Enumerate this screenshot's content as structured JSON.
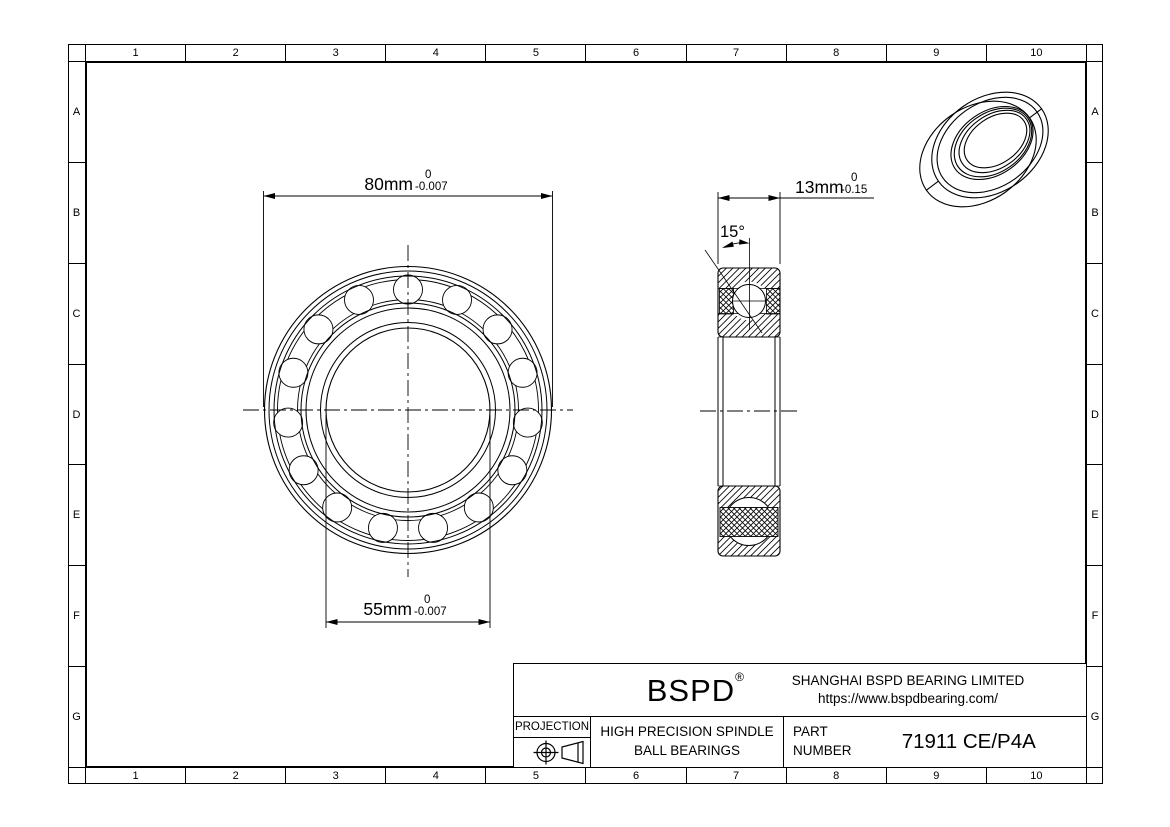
{
  "sheet": {
    "grid": {
      "columns": [
        "1",
        "2",
        "3",
        "4",
        "5",
        "6",
        "7",
        "8",
        "9",
        "10"
      ],
      "rows": [
        "A",
        "B",
        "C",
        "D",
        "E",
        "F",
        "G"
      ]
    },
    "colors": {
      "line": "#000000",
      "background": "#ffffff"
    }
  },
  "dimensions": {
    "outer_diameter": {
      "value": "80mm",
      "tol_upper": "0",
      "tol_lower": "-0.007"
    },
    "bore_diameter": {
      "value": "55mm",
      "tol_upper": "0",
      "tol_lower": "-0.007"
    },
    "width": {
      "value": "13mm",
      "tol_upper": "0",
      "tol_lower": "-0.15"
    },
    "contact_angle": {
      "value": "15°"
    }
  },
  "title_block": {
    "brand": "BSPD",
    "registered_mark": "®",
    "company": "SHANGHAI BSPD BEARING LIMITED",
    "website": "https://www.bspdbearing.com/",
    "projection_label": "PROJECTION",
    "product_line1": "HIGH  PRECISION SPINDLE",
    "product_line2": "BALL BEARINGS",
    "part_label_line1": "PART",
    "part_label_line2": "NUMBER",
    "part_number": "71911 CE/P4A"
  }
}
